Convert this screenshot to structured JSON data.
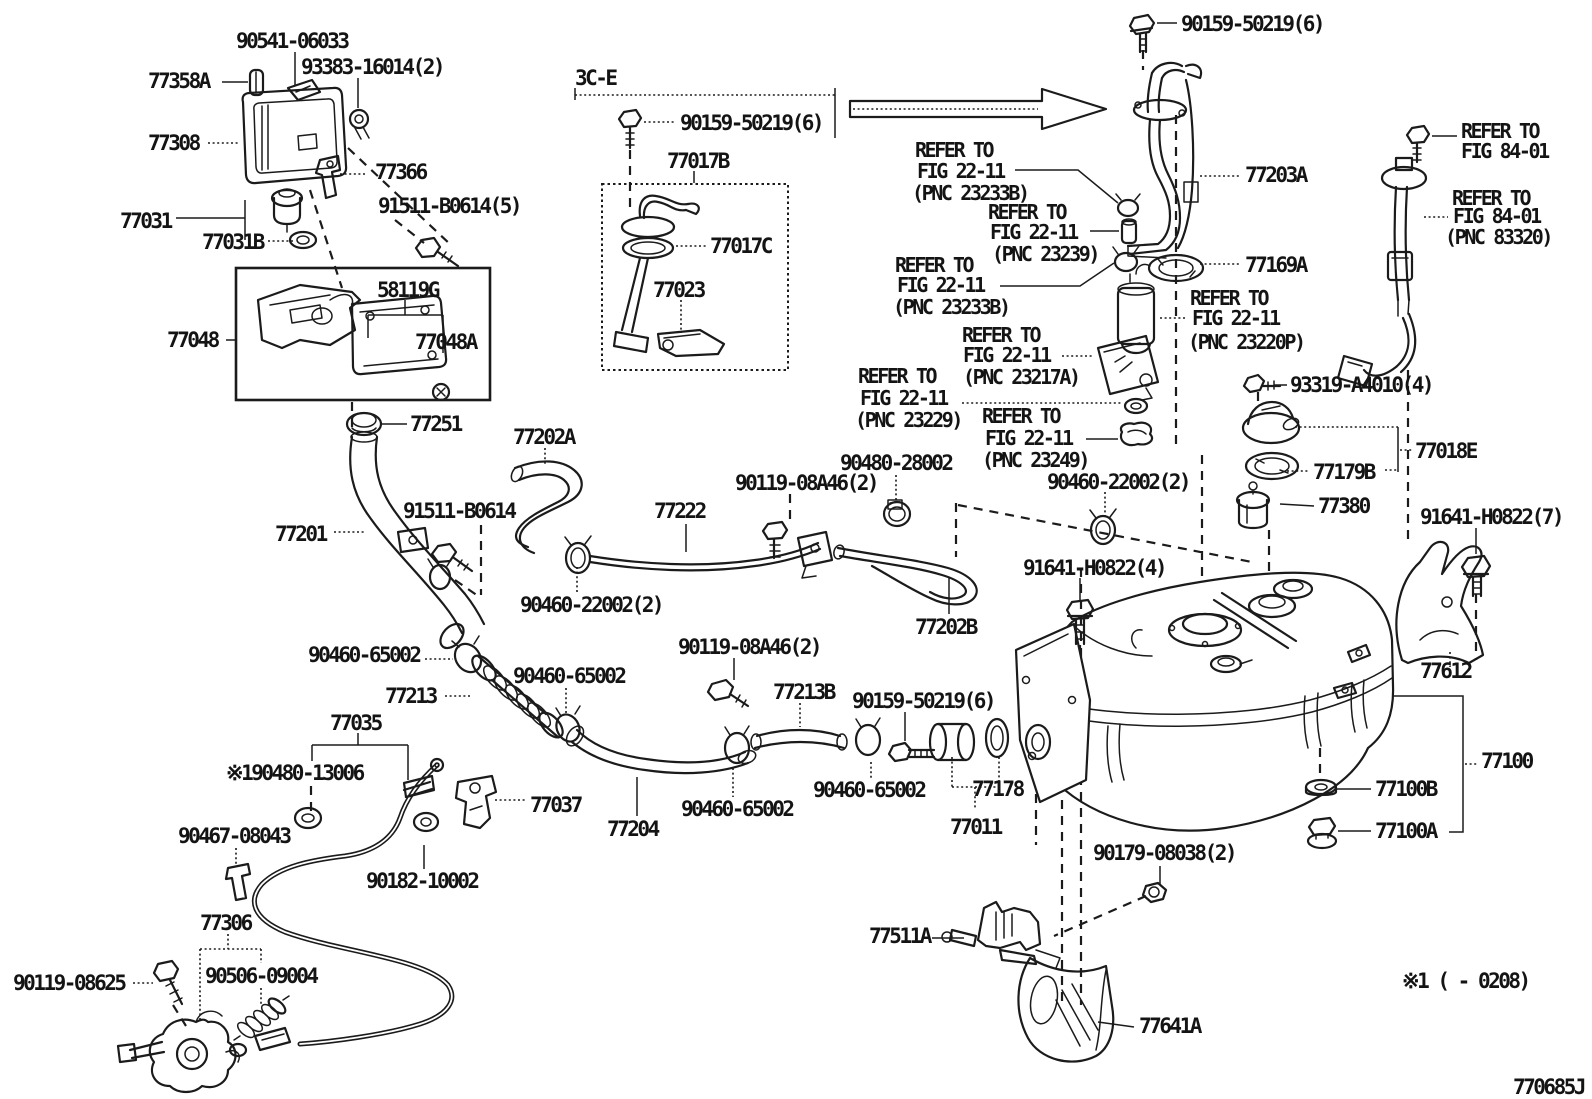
{
  "diagram": {
    "figure_code": "770685J",
    "applicability_note": "※1 (      - 0208)",
    "section_ref": "3C-E"
  },
  "parts": {
    "p90541_06033": "90541-06033",
    "p77358A": "77358A",
    "p93383_16014": "93383-16014(2)",
    "p77308": "77308",
    "p77366": "77366",
    "p77031": "77031",
    "p77031B": "77031B",
    "p91511_B0614_5": "91511-B0614(5)",
    "p58119G": "58119G",
    "p77048": "77048",
    "p77048A": "77048A",
    "p77251": "77251",
    "p90159_50219": "90159-50219(6)",
    "p77017B": "77017B",
    "p77017C": "77017C",
    "p77023": "77023",
    "p77203A": "77203A",
    "p77169A": "77169A",
    "p93319_A4010": "93319-A4010(4)",
    "p77018E": "77018E",
    "p77179B": "77179B",
    "p77380": "77380",
    "p91641_H0822_7": "91641-H0822(7)",
    "p77612": "77612",
    "p77100": "77100",
    "p77100B": "77100B",
    "p77100A": "77100A",
    "p77202A": "77202A",
    "p77201": "77201",
    "p91511_B0614": "91511-B0614",
    "p77222": "77222",
    "p90460_22002": "90460-22002(2)",
    "p90480_28002": "90480-28002",
    "p90119_08A46": "90119-08A46(2)",
    "p91641_H0822_4": "91641-H0822(4)",
    "p77202B": "77202B",
    "p90460_65002": "90460-65002",
    "p77213": "77213",
    "p77035": "77035",
    "p90480_13006_note": "※190480-13006",
    "p90467_08043": "90467-08043",
    "p77037": "77037",
    "p90182_10002": "90182-10002",
    "p77306": "77306",
    "p90119_08625": "90119-08625",
    "p90506_09004": "90506-09004",
    "p77213B": "77213B",
    "p77178": "77178",
    "p77011": "77011",
    "p77204": "77204",
    "p77511A": "77511A",
    "p90179_08038": "90179-08038(2)",
    "p77641A": "77641A"
  },
  "references": {
    "refer_to": "REFER TO",
    "fig_22_11": "FIG 22-11",
    "fig_84_01": "FIG 84-01",
    "pnc_23233B": "(PNC 23233B)",
    "pnc_23239": "(PNC 23239)",
    "pnc_23220P": "(PNC 23220P)",
    "pnc_23217A": "(PNC 23217A)",
    "pnc_23229": "(PNC 23229)",
    "pnc_23249": "(PNC 23249)",
    "pnc_83320": "(PNC 83320)"
  }
}
